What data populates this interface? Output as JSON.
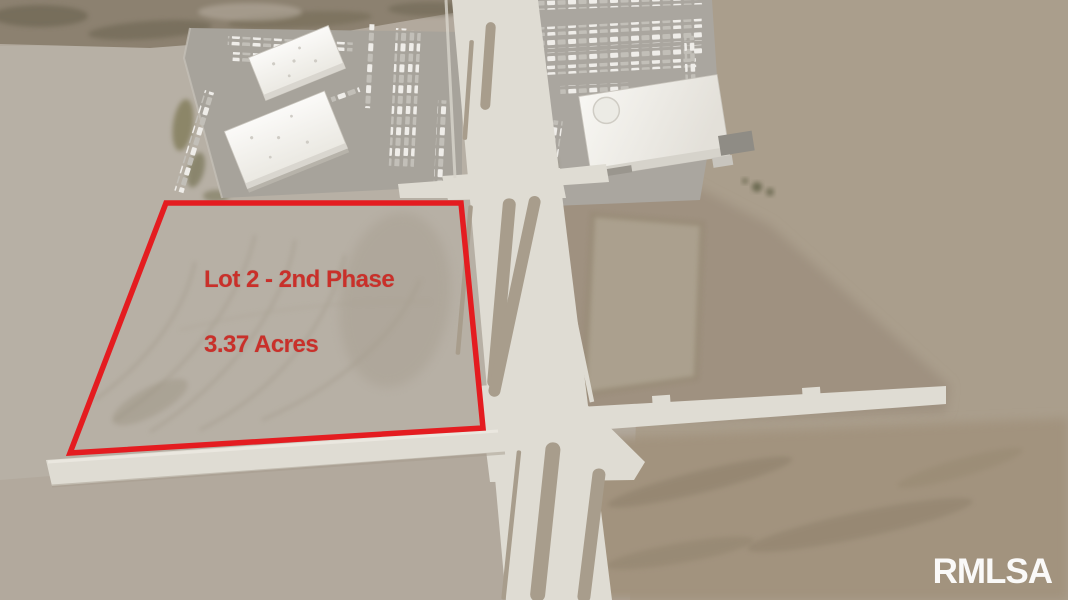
{
  "image": {
    "type": "aerial-photo",
    "subject": "vacant graded commercial lot outlined in red beside a divided boulevard, warehouse buildings and a retail building with parking lots"
  },
  "annotation": {
    "lot_label": "Lot 2 - 2nd Phase",
    "acreage_label": "3.37 Acres",
    "text_color": "#c9302a",
    "outline_color": "#e41c20"
  },
  "watermark": {
    "text": "RMLSA",
    "color": "#ffffff"
  },
  "palette": {
    "dirt_base": "#b2a99d",
    "dirt_dark": "#9c8f7c",
    "scrub": "#8c8170",
    "road_concrete": "#dfdcd3",
    "median_dirt": "#a89d8c",
    "building_roof": "#f6f5f1",
    "parking_asphalt": "#a7a39b"
  }
}
